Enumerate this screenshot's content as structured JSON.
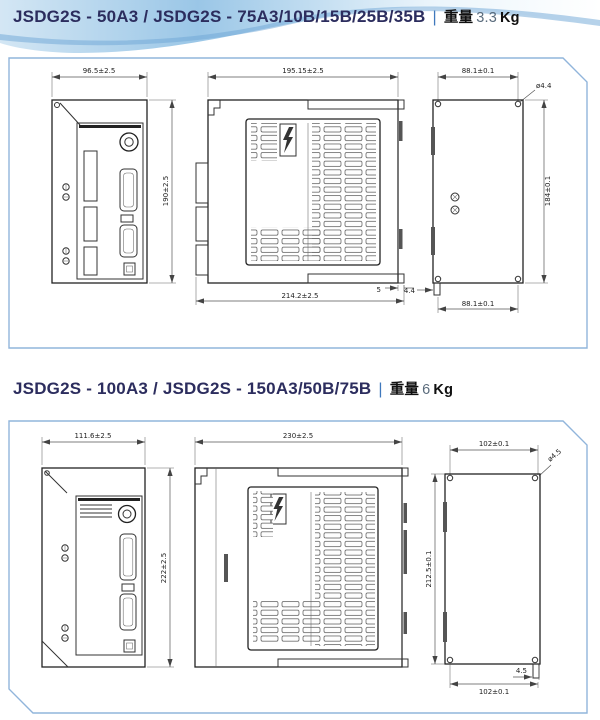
{
  "page": {
    "title_color": "#2c2d5e",
    "accent_blue": "#6fa3d4",
    "panel_border": "#91b5db"
  },
  "sections": [
    {
      "model_title": "JSDG2S - 50A3 / JSDG2S - 75A3/10B/15B/25B/35B",
      "separator": "|",
      "weight_label": "重量",
      "weight_value": "3.3",
      "weight_unit": "Kg",
      "dims": {
        "front_width": "96.5±2.5",
        "front_height": "190±2.5",
        "side_depth": "195.15±2.5",
        "overall_depth": "214.2±2.5",
        "bracket_offset": "5",
        "rear_hole_pitch_w_top": "88.1±0.1",
        "rear_hole_dia": "ø4.4",
        "rear_hole_pitch_h": "184±0.1",
        "rear_hole_pitch_w_bottom": "88.1±0.1",
        "rear_tab_width": "4.4"
      }
    },
    {
      "model_title": "JSDG2S - 100A3 / JSDG2S - 150A3/50B/75B",
      "separator": "|",
      "weight_label": "重量",
      "weight_value": "6",
      "weight_unit": "Kg",
      "dims": {
        "front_width": "111.6±2.5",
        "front_height": "222±2.5",
        "side_depth": "230±2.5",
        "rear_hole_pitch_w_top": "102±0.1",
        "rear_hole_dia": "ø4.5",
        "rear_hole_pitch_h": "212.5±0.1",
        "rear_hole_pitch_w_bottom": "102±0.1",
        "rear_tab_width": "4.5"
      }
    }
  ]
}
